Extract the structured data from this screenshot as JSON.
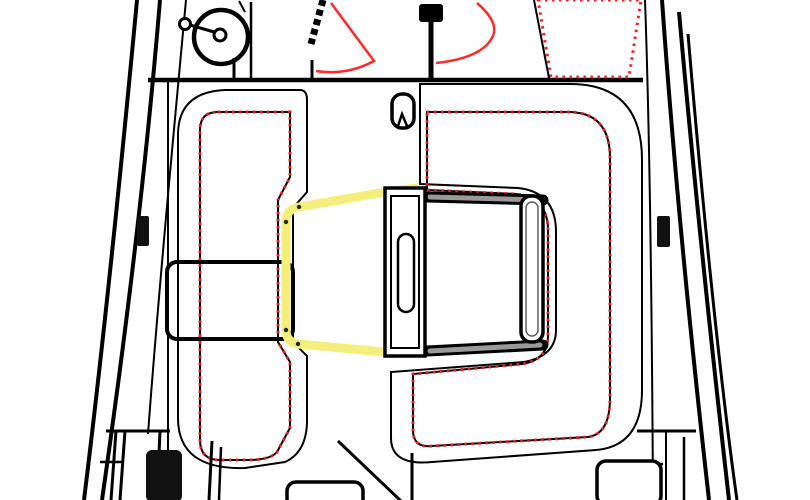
{
  "colors": {
    "line": "#000000",
    "fitting_black": "#111111",
    "cushion_dot": "#f43333",
    "cushion_edge": "#ee2222",
    "accent_red": "#ff2a2a",
    "highlight_yellow": "#f4ef7d",
    "trim_dot": "#222222",
    "band_base": "#9c9c9c",
    "band_streak_dark": "#5f5f5f",
    "band_streak_mid": "#787878",
    "rail_core": "#9a9a9a",
    "white": "#ffffff"
  },
  "drawing": {
    "kind": "sailboat-cockpit-deck-plan-top-view",
    "elements": [
      {
        "name": "hull-port-outer",
        "tag": "path",
        "attrs": {
          "d": "M137,0 C122,160 105,330 84,500",
          "stroke": "$line",
          "stroke-width": "4",
          "fill": "none"
        }
      },
      {
        "name": "hull-port-mid",
        "tag": "path",
        "attrs": {
          "d": "M160,0 C146,170 125,340 102,500",
          "stroke": "$line",
          "stroke-width": "4",
          "fill": "none"
        }
      },
      {
        "name": "hull-port-inner",
        "tag": "path",
        "attrs": {
          "d": "M186,0 C172,150 158,300 148,434",
          "stroke": "$line",
          "stroke-width": "2",
          "fill": "none"
        }
      },
      {
        "name": "hull-stbd-inner",
        "tag": "path",
        "attrs": {
          "d": "M645,0 C650,140 652,320 653,500",
          "stroke": "$line",
          "stroke-width": "2",
          "fill": "none"
        }
      },
      {
        "name": "hull-stbd-mid",
        "tag": "path",
        "attrs": {
          "d": "M662,0 C674,170 692,350 709,500",
          "stroke": "$line",
          "stroke-width": "4",
          "fill": "none"
        }
      },
      {
        "name": "hull-stbd-outer",
        "tag": "path",
        "attrs": {
          "d": "M679,12 C694,180 713,360 729,500",
          "stroke": "$line",
          "stroke-width": "4",
          "fill": "none"
        }
      },
      {
        "name": "hull-stbd-rubrail",
        "tag": "path",
        "attrs": {
          "d": "M688,34 C702,200 720,380 737,500",
          "stroke": "$line",
          "stroke-width": "3",
          "fill": "none"
        }
      },
      {
        "name": "cockpit-forward-beam",
        "tag": "line",
        "attrs": {
          "x1": "148",
          "y1": "80",
          "x2": "643",
          "y2": "80",
          "stroke": "$line",
          "stroke-width": "4.5"
        }
      },
      {
        "name": "port-cockpit-wall",
        "tag": "line",
        "attrs": {
          "x1": "168",
          "y1": "80",
          "x2": "168",
          "y2": "452",
          "stroke": "$line",
          "stroke-width": "2"
        }
      },
      {
        "name": "sidedeck-sunpad",
        "tag": "path",
        "attrs": {
          "d": "M538,0 L641,0 L629,77 L551,77 Z",
          "fill": "url(#dots)",
          "stroke": "$cushion_edge",
          "stroke-width": "3",
          "stroke-dasharray": "2.5 4.5"
        }
      },
      {
        "name": "cabin-trunk-edge",
        "tag": "line",
        "attrs": {
          "x1": "534",
          "y1": "0",
          "x2": "549",
          "y2": "78",
          "stroke": "$line",
          "stroke-width": "2"
        }
      },
      {
        "name": "winch-drum",
        "tag": "circle",
        "attrs": {
          "cx": "221",
          "cy": "37",
          "r": "27",
          "stroke": "$line",
          "stroke-width": "4.5",
          "fill": "$white"
        }
      },
      {
        "name": "winch-hub",
        "tag": "circle",
        "attrs": {
          "cx": "220",
          "cy": "35",
          "r": "6",
          "stroke": "$line",
          "stroke-width": "3",
          "fill": "$white"
        }
      },
      {
        "name": "winch-handle",
        "tag": "line",
        "attrs": {
          "x1": "214",
          "y1": "32",
          "x2": "190",
          "y2": "25",
          "stroke": "$line",
          "stroke-width": "3"
        }
      },
      {
        "name": "winch-handle-knob",
        "tag": "circle",
        "attrs": {
          "cx": "185",
          "cy": "24",
          "r": "5.5",
          "stroke": "$line",
          "stroke-width": "3",
          "fill": "$white"
        }
      },
      {
        "name": "winch-line-stub",
        "tag": "line",
        "attrs": {
          "x1": "239",
          "y1": "1",
          "x2": "245",
          "y2": "12",
          "stroke": "$line",
          "stroke-width": "2"
        }
      },
      {
        "name": "winch-sheet-drop",
        "tag": "line",
        "attrs": {
          "x1": "234",
          "y1": "58",
          "x2": "234",
          "y2": "80",
          "stroke": "$line",
          "stroke-width": "3"
        }
      },
      {
        "name": "jib-sheet-line",
        "tag": "line",
        "attrs": {
          "x1": "251",
          "y1": "2",
          "x2": "251",
          "y2": "78",
          "stroke": "$line",
          "stroke-width": "2.5"
        }
      },
      {
        "name": "halyard-stack",
        "tag": "line",
        "attrs": {
          "x1": "323",
          "y1": "0",
          "x2": "311",
          "y2": "44",
          "stroke": "$line",
          "stroke-width": "7",
          "stroke-dasharray": "6 4"
        }
      },
      {
        "name": "halyard-stack-arrow",
        "tag": "path",
        "attrs": {
          "d": "M300,44 L324,38 L319,58 L307,64 Z",
          "fill": "$line"
        }
      },
      {
        "name": "halyard-stack-drop",
        "tag": "line",
        "attrs": {
          "x1": "312",
          "y1": "60",
          "x2": "312",
          "y2": "80",
          "stroke": "$line",
          "stroke-width": "3"
        }
      },
      {
        "name": "sheet-lead-fan-port",
        "tag": "path",
        "attrs": {
          "d": "M331,3 L374,61 Q346,76 316,71",
          "stroke": "$accent_red",
          "stroke-width": "2.5",
          "fill": "none"
        }
      },
      {
        "name": "mast-post-block",
        "tag": "rect",
        "attrs": {
          "x": "419",
          "y": "4",
          "width": "24",
          "height": "18",
          "rx": "3",
          "fill": "$line"
        }
      },
      {
        "name": "mast-post-line",
        "tag": "line",
        "attrs": {
          "x1": "431",
          "y1": "4",
          "x2": "431",
          "y2": "80",
          "stroke": "$line",
          "stroke-width": "5"
        }
      },
      {
        "name": "sheet-lead-fan-stbd",
        "tag": "path",
        "attrs": {
          "d": "M477,3 Q499,22 493,36 Q483,58 436,63",
          "stroke": "$accent_red",
          "stroke-width": "2.5",
          "fill": "none"
        }
      },
      {
        "name": "port-seat-base",
        "tag": "path",
        "attrs": {
          "d": "M225,90 H300 Q307,90 307,100 V192 L293,208 V342 L307,356 V420 Q307,452 285,462 L245,468 Q178,470 178,418 V135 Q178,92 225,90 Z M218,112 H290 V177 L278,200 V342 L290,362 V428 L277,452 Q270,460 248,460 H220 Q200,460 200,440 V130 Q200,112 218,112 Z",
          "fill": "url(#band)",
          "fill-rule": "evenodd",
          "stroke": "$line",
          "stroke-width": "2"
        }
      },
      {
        "name": "port-seat-cushion",
        "tag": "path",
        "attrs": {
          "d": "M218,112 H290 V177 L278,200 V342 L290,362 V428 L277,452 Q270,460 248,460 H220 Q200,460 200,440 V130 Q200,112 218,112 Z",
          "fill": "url(#dots)",
          "stroke": "$cushion_edge",
          "stroke-width": "3",
          "stroke-dasharray": "2.5 4.5"
        }
      },
      {
        "name": "port-locker-lid",
        "tag": "rect",
        "attrs": {
          "x": "167",
          "y": "262",
          "width": "126",
          "height": "77",
          "rx": "10",
          "stroke": "$line",
          "stroke-width": "4",
          "fill": "none"
        }
      },
      {
        "name": "yellow-edge-trim",
        "tag": "path",
        "attrs": {
          "d": "M418,188 L385,192 L299,207 Q286,209 286,222 L286,330 Q286,342 298,344 L385,352 L397,354",
          "stroke": "$highlight_yellow",
          "stroke-width": "9",
          "stroke-linejoin": "round",
          "fill": "none"
        }
      },
      {
        "name": "trim-fastener-dot",
        "tag": "circle",
        "attrs": {
          "cx": "299",
          "cy": "207",
          "r": "2.2",
          "fill": "$trim_dot"
        }
      },
      {
        "name": "trim-fastener-dot",
        "tag": "circle",
        "attrs": {
          "cx": "286",
          "cy": "222",
          "r": "2.2",
          "fill": "$trim_dot"
        }
      },
      {
        "name": "trim-fastener-dot",
        "tag": "circle",
        "attrs": {
          "cx": "286",
          "cy": "330",
          "r": "2.2",
          "fill": "$trim_dot"
        }
      },
      {
        "name": "trim-fastener-dot",
        "tag": "circle",
        "attrs": {
          "cx": "298",
          "cy": "344",
          "r": "2.2",
          "fill": "$trim_dot"
        }
      },
      {
        "name": "trim-fastener-dot",
        "tag": "circle",
        "attrs": {
          "cx": "416",
          "cy": "189",
          "r": "2.2",
          "fill": "$trim_dot"
        }
      },
      {
        "name": "trim-fastener-dot",
        "tag": "circle",
        "attrs": {
          "cx": "395",
          "cy": "353",
          "r": "2.2",
          "fill": "$trim_dot"
        }
      },
      {
        "name": "stbd-seat-base",
        "tag": "path",
        "attrs": {
          "d": "M420,84 H570 Q642,84 642,160 V390 Q642,446 596,450 L432,462 Q391,466 391,438 V372 L524,362 Q556,356 556,330 V232 Q556,192 518,188 L420,184 Z M427,112 H568 Q610,112 610,158 V398 Q610,434 588,437 L432,446 Q413,448 413,430 V374 L522,364 Q548,360 548,336 V230 Q548,198 516,194 L427,190 Z",
          "fill": "url(#band)",
          "fill-rule": "evenodd",
          "stroke": "$line",
          "stroke-width": "2"
        }
      },
      {
        "name": "stbd-seat-cushion",
        "tag": "path",
        "attrs": {
          "d": "M427,112 H568 Q610,112 610,158 V398 Q610,434 588,437 L432,446 Q413,448 413,430 V374 L522,364 Q548,360 548,336 V230 Q548,198 516,194 L427,190 Z",
          "fill": "url(#dots)",
          "stroke": "$cushion_edge",
          "stroke-width": "3",
          "stroke-dasharray": "2.5 4.5"
        }
      },
      {
        "name": "table-top-rail",
        "tag": "line",
        "attrs": {
          "x1": "427",
          "y1": "197",
          "x2": "543",
          "y2": "200",
          "stroke": "$line",
          "stroke-width": "11",
          "stroke-linecap": "round"
        }
      },
      {
        "name": "table-top-rail-core",
        "tag": "line",
        "attrs": {
          "x1": "430",
          "y1": "197",
          "x2": "540",
          "y2": "200",
          "stroke": "$rail_core",
          "stroke-width": "5",
          "stroke-linecap": "round"
        }
      },
      {
        "name": "table-bottom-rail",
        "tag": "line",
        "attrs": {
          "x1": "427",
          "y1": "351",
          "x2": "543",
          "y2": "345",
          "stroke": "$line",
          "stroke-width": "11",
          "stroke-linecap": "round"
        }
      },
      {
        "name": "table-bottom-rail-core",
        "tag": "line",
        "attrs": {
          "x1": "430",
          "y1": "351",
          "x2": "540",
          "y2": "345",
          "stroke": "$rail_core",
          "stroke-width": "5",
          "stroke-linecap": "round"
        }
      },
      {
        "name": "table-side-bar",
        "tag": "rect",
        "attrs": {
          "x": "521",
          "y": "196",
          "width": "22",
          "height": "146",
          "rx": "10",
          "stroke": "$line",
          "stroke-width": "3.5",
          "fill": "$white"
        }
      },
      {
        "name": "table-side-bar-inner",
        "tag": "rect",
        "attrs": {
          "x": "526",
          "y": "202",
          "width": "12",
          "height": "134",
          "rx": "6",
          "stroke": "$band_streak_dark",
          "stroke-width": "1.5",
          "fill": "none"
        }
      },
      {
        "name": "table-leaf",
        "tag": "rect",
        "attrs": {
          "x": "385",
          "y": "188",
          "width": "40",
          "height": "168",
          "stroke": "$line",
          "stroke-width": "3.5",
          "fill": "$white"
        }
      },
      {
        "name": "table-leaf-inner",
        "tag": "rect",
        "attrs": {
          "x": "391",
          "y": "196",
          "width": "28",
          "height": "152",
          "stroke": "$line",
          "stroke-width": "2",
          "fill": "none"
        }
      },
      {
        "name": "table-leaf-handle",
        "tag": "rect",
        "attrs": {
          "x": "398",
          "y": "234",
          "width": "16",
          "height": "78",
          "rx": "8",
          "stroke": "$line",
          "stroke-width": "2.5",
          "fill": "$white"
        }
      },
      {
        "name": "table-padeye",
        "tag": "rect",
        "attrs": {
          "x": "392",
          "y": "94",
          "width": "22",
          "height": "34",
          "rx": "10",
          "stroke": "$line",
          "stroke-width": "3.5",
          "fill": "$white"
        }
      },
      {
        "name": "table-padeye-notch",
        "tag": "path",
        "attrs": {
          "d": "M398,126 L402,114 L407,126",
          "stroke": "$line",
          "stroke-width": "2.5",
          "fill": "none"
        }
      },
      {
        "name": "port-deck-cleat",
        "tag": "rect",
        "attrs": {
          "x": "137",
          "y": "216",
          "width": "12",
          "height": "30",
          "rx": "2",
          "fill": "$fitting_black"
        }
      },
      {
        "name": "stbd-deck-cleat",
        "tag": "rect",
        "attrs": {
          "x": "657",
          "y": "216",
          "width": "13",
          "height": "31",
          "rx": "2",
          "fill": "$fitting_black"
        }
      },
      {
        "name": "stern-line-port",
        "tag": "line",
        "attrs": {
          "x1": "106",
          "y1": "431",
          "x2": "170",
          "y2": "431",
          "stroke": "$line",
          "stroke-width": "3"
        }
      },
      {
        "name": "port-stern-post-a",
        "tag": "line",
        "attrs": {
          "x1": "116",
          "y1": "431",
          "x2": "111",
          "y2": "500",
          "stroke": "$line",
          "stroke-width": "3"
        }
      },
      {
        "name": "port-stern-post-b",
        "tag": "line",
        "attrs": {
          "x1": "125",
          "y1": "431",
          "x2": "120",
          "y2": "500",
          "stroke": "$line",
          "stroke-width": "3"
        }
      },
      {
        "name": "port-stern-post-c",
        "tag": "line",
        "attrs": {
          "x1": "160",
          "y1": "431",
          "x2": "157",
          "y2": "500",
          "stroke": "$line",
          "stroke-width": "3"
        }
      },
      {
        "name": "port-stern-step",
        "tag": "line",
        "attrs": {
          "x1": "100",
          "y1": "462",
          "x2": "122",
          "y2": "462",
          "stroke": "$line",
          "stroke-width": "2.5"
        }
      },
      {
        "name": "port-pedestal",
        "tag": "rect",
        "attrs": {
          "x": "146",
          "y": "450",
          "width": "36",
          "height": "52",
          "rx": "6",
          "fill": "$fitting_black"
        }
      },
      {
        "name": "companionway-post-a",
        "tag": "line",
        "attrs": {
          "x1": "212",
          "y1": "441",
          "x2": "209",
          "y2": "500",
          "stroke": "$line",
          "stroke-width": "3"
        }
      },
      {
        "name": "companionway-post-b",
        "tag": "line",
        "attrs": {
          "x1": "221",
          "y1": "447",
          "x2": "219",
          "y2": "500",
          "stroke": "$line",
          "stroke-width": "2.5"
        }
      },
      {
        "name": "port-mooring-cleat",
        "tag": "path",
        "attrs": {
          "d": "M239,464 Q237,452 251,450 L292,448 Q305,448 303,460 L299,472 Q278,478 258,473 L244,472 Q239,470 239,464 Z",
          "fill": "$fitting_black"
        }
      },
      {
        "name": "center-hatch",
        "tag": "rect",
        "attrs": {
          "x": "287",
          "y": "482",
          "width": "76",
          "height": "26",
          "rx": "9",
          "stroke": "$line",
          "stroke-width": "3.5",
          "fill": "$white"
        }
      },
      {
        "name": "cockpit-sole-edge",
        "tag": "line",
        "attrs": {
          "x1": "338",
          "y1": "441",
          "x2": "402",
          "y2": "502",
          "stroke": "$line",
          "stroke-width": "3"
        }
      },
      {
        "name": "helm-post",
        "tag": "line",
        "attrs": {
          "x1": "412",
          "y1": "453",
          "x2": "412",
          "y2": "502",
          "stroke": "$line",
          "stroke-width": "3"
        }
      },
      {
        "name": "stern-line-stbd",
        "tag": "line",
        "attrs": {
          "x1": "637",
          "y1": "431",
          "x2": "696",
          "y2": "431",
          "stroke": "$line",
          "stroke-width": "3"
        }
      },
      {
        "name": "stbd-stern-post-a",
        "tag": "line",
        "attrs": {
          "x1": "666",
          "y1": "431",
          "x2": "666",
          "y2": "502",
          "stroke": "$line",
          "stroke-width": "2"
        }
      },
      {
        "name": "stbd-stern-step",
        "tag": "line",
        "attrs": {
          "x1": "640",
          "y1": "464",
          "x2": "663",
          "y2": "464",
          "stroke": "$line",
          "stroke-width": "2.5"
        }
      },
      {
        "name": "stbd-stern-post-b",
        "tag": "line",
        "attrs": {
          "x1": "684",
          "y1": "437",
          "x2": "684",
          "y2": "502",
          "stroke": "$line",
          "stroke-width": "2.5"
        }
      },
      {
        "name": "stbd-hatch",
        "tag": "rect",
        "attrs": {
          "x": "597",
          "y": "461",
          "width": "64",
          "height": "44",
          "rx": "9",
          "stroke": "$line",
          "stroke-width": "3.5",
          "fill": "$white"
        }
      },
      {
        "name": "stbd-mooring-cleat",
        "tag": "path",
        "attrs": {
          "d": "M516,490 Q514,480 528,478 L536,470 L546,476 L566,476 Q580,476 578,488 L575,502 L520,502 Z",
          "fill": "$fitting_black"
        }
      }
    ]
  }
}
